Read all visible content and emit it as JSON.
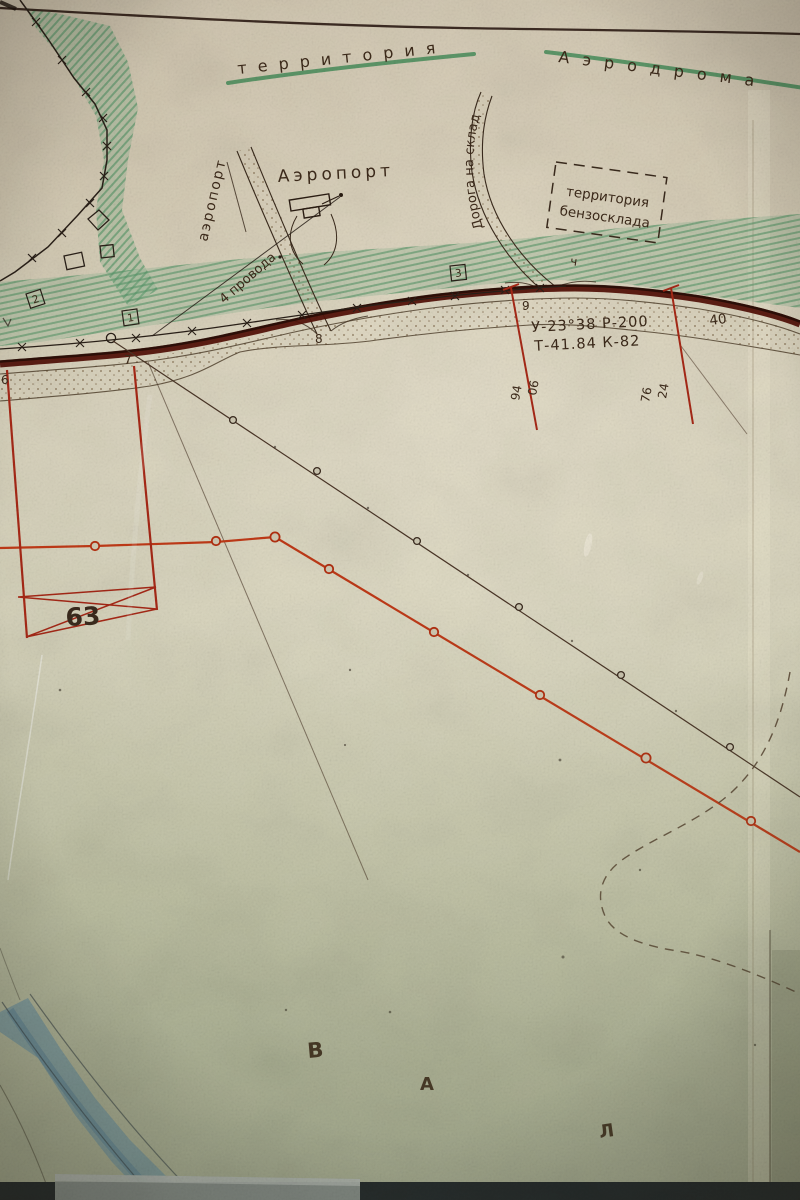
{
  "labels": {
    "territory": "т е р р и т о р и я",
    "aerodrome": "А э р о д р о м а",
    "airport": "Аэропорт",
    "airport_vertical": "аэропорт",
    "road_to_warehouse": "Дорога на склад",
    "fuel_depot_line1": "территория",
    "fuel_depot_line2": "бензосклада",
    "fuel_depot_note": "ч",
    "wires": "4 провода",
    "survey_note_line1": "У-23°38  Р-200",
    "survey_note_line2": "Т-41.84  К-82",
    "road_value": "40",
    "parcel_number": "63",
    "point_6": "6",
    "point_7": "7",
    "point_8": "8",
    "point_9": "9",
    "box_1": "1",
    "box_2": "2",
    "box_3": "3",
    "station_94": "94",
    "station_06": "06",
    "station_76": "76",
    "station_24": "24",
    "letter_v": "В",
    "letter_a": "А",
    "letter_l": "Л"
  },
  "colors": {
    "paper": "#d5ceb8",
    "road_edge": "#4a140c",
    "survey_red": "#a82816",
    "power_line_red": "#c23a17",
    "vegetation_green": "#4a9160",
    "water_blue": "#4f86ad",
    "ink": "#3a2a1c"
  }
}
